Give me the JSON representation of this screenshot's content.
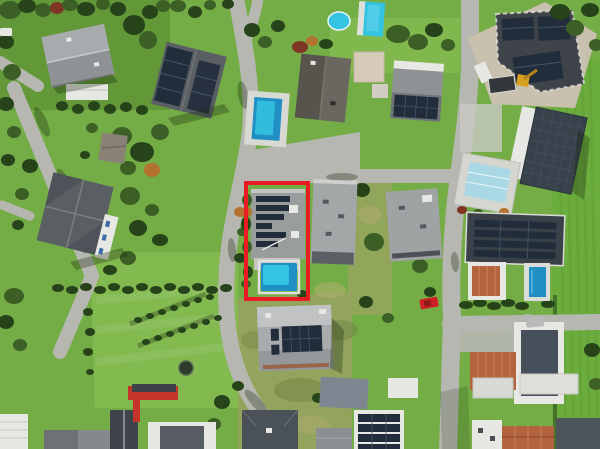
{
  "scene": {
    "type": "aerial-drone-photograph",
    "description": "Top-down aerial view of a suburban residential neighborhood with lawns, trees, roads, flat- and gable-roof houses with rooftop solar panels, several swimming pools, a construction site, and one property outlined by a red marker rectangle"
  },
  "highlight": {
    "x": 244,
    "y": 181,
    "width": 66,
    "height": 120,
    "color": "#e81c22",
    "stroke_width": 4,
    "label": "highlighted-property"
  },
  "colors": {
    "lawn_base": "#74ad45",
    "lawn_bright": "#83ba50",
    "lawn_dark": "#55862f",
    "field": "#6cae3e",
    "scrub": "#97a35f",
    "scrub_dark": "#6f8142",
    "road": "#b6b7b1",
    "road_light": "#c8c9c3",
    "gravel": "#c9c0ae",
    "tree": "#3c5f25",
    "tree_dark": "#27431a",
    "tree_red": "#7e3524",
    "tree_orange": "#b5722f",
    "roof_light": "#b3b6b7",
    "roof_mid": "#8f9294",
    "roof_gray": "#5a5f64",
    "roof_dark": "#3e444a",
    "solar": "#222d3b",
    "solar_line": "#44546a",
    "white_struct": "#e7e7e4",
    "terracotta": "#b3643f",
    "pool": "#35c3e2",
    "pool_deep": "#1f8fc4",
    "pool_pale": "#a9d7e4"
  },
  "objects": [
    {
      "name": "highlighted-property",
      "type": "flat-roof house with solar strips and small turquoise pool, outlined in red"
    },
    {
      "name": "circular-pool",
      "type": "round swimming pool, top center"
    },
    {
      "name": "rectangular-pool-top",
      "type": "rectangular pool, top center"
    },
    {
      "name": "garden-pool-center",
      "type": "rectangular pool beside gabled house"
    },
    {
      "name": "construction-site",
      "type": "building under construction with solar roof, gravel yard, van and excavator, top right"
    },
    {
      "name": "solar-roof-house-right",
      "type": "large house with full solar roof and pale pool terrace, middle right"
    },
    {
      "name": "solar-strip-house-right",
      "type": "house with horizontal solar rows, terracotta annex and small blue pool"
    },
    {
      "name": "gabled-house-top-left",
      "type": "gray gabled house among trees"
    },
    {
      "name": "solar-gable-house",
      "type": "dark gabled house with solar slopes, upper center-left"
    },
    {
      "name": "cross-gable-house-left",
      "type": "dark cross-gabled house, middle left"
    },
    {
      "name": "hip-roof-solar-house-bottom-center",
      "type": "light hip roof with solar array"
    },
    {
      "name": "meadow-with-garden-rows",
      "type": "large lawn with two diagonal planted rows and trampoline, lower left"
    },
    {
      "name": "red-trailer",
      "type": "red trailer/container at bottom of meadow"
    },
    {
      "name": "red-car",
      "type": "small red vehicle parked near center-right road"
    },
    {
      "name": "green-field-right-edge",
      "type": "striped farm field along right edge"
    },
    {
      "name": "road-network",
      "type": "light gray residential streets with cul-de-sac"
    }
  ]
}
